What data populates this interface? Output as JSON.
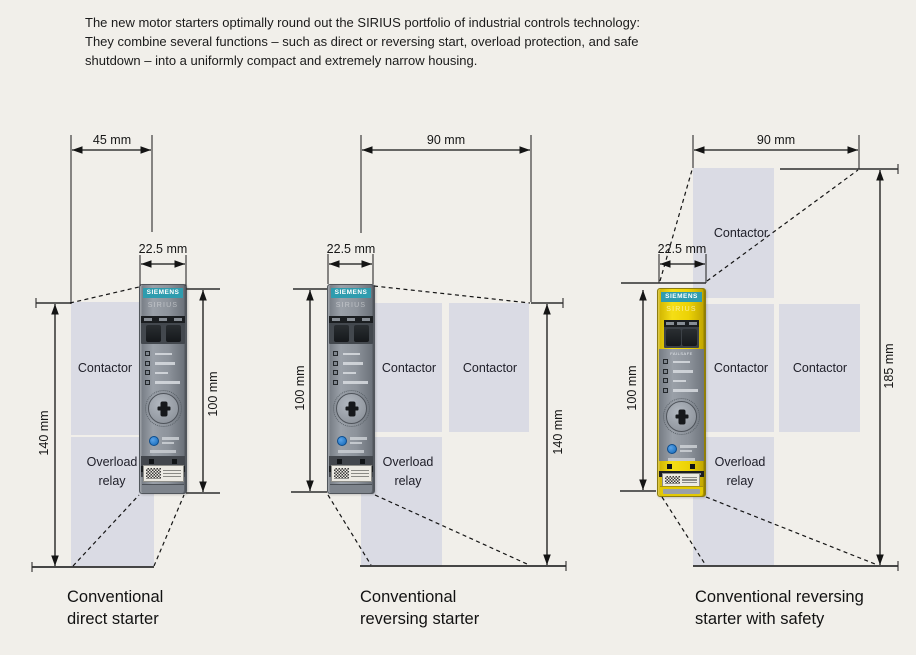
{
  "intro": {
    "line1": "The new motor starters optimally round out the SIRIUS portfolio of industrial controls technology:",
    "line2": "They combine several functions – such as direct or reversing start, overload protection, and safe",
    "line3": "shutdown – into a uniformly compact and extremely narrow housing."
  },
  "device": {
    "brand": "SIEMENS",
    "series": "SIRIUS",
    "safety_marking": "FAILSAFE"
  },
  "colors": {
    "background": "#f1efea",
    "placeholder_box": "#dadbe4",
    "siemens_teal": "#2f9cae",
    "safety_yellow": "#ecd205",
    "device_gray": "#8d939b",
    "line": "#1c1c1c"
  },
  "diagrams": [
    {
      "caption": {
        "line1": "Conventional",
        "line2": "direct starter"
      },
      "dimensions": {
        "outer_width": "45 mm",
        "device_width": "22.5 mm",
        "outer_height": "140 mm",
        "device_height": "100 mm"
      },
      "labels": {
        "contactor": "Contactor",
        "overload_line1": "Overload",
        "overload_line2": "relay"
      }
    },
    {
      "caption": {
        "line1": "Conventional",
        "line2": "reversing starter"
      },
      "dimensions": {
        "outer_width": "90 mm",
        "device_width": "22.5 mm",
        "outer_height": "140 mm",
        "device_height": "100 mm"
      },
      "labels": {
        "contactor_left": "Contactor",
        "contactor_right": "Contactor",
        "overload_line1": "Overload",
        "overload_line2": "relay"
      }
    },
    {
      "caption": {
        "line1": "Conventional reversing",
        "line2": "starter with safety"
      },
      "dimensions": {
        "outer_width": "90 mm",
        "device_width": "22.5 mm",
        "outer_height": "185 mm",
        "device_height": "100 mm"
      },
      "labels": {
        "contactor_top": "Contactor",
        "contactor_left": "Contactor",
        "contactor_right": "Contactor",
        "overload_line1": "Overload",
        "overload_line2": "relay"
      }
    }
  ]
}
